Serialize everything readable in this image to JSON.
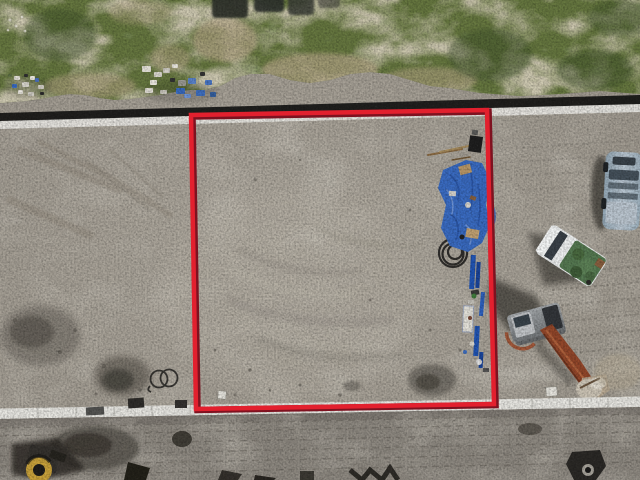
{
  "scene": {
    "type": "aerial-drone-photograph",
    "description": "Top-down drone photo of a graded vacant dirt lot outlined by a red rectangular property-boundary overlay; grass verge, debris piles and asphalt road edge across the top, white concrete curbs, a blue tarp with boxes and blue pipes along the right boundary, hose coils, dark excavation patches, a silver SUV, a white pickup with a green tarped load, a mini excavator, and a small compactor machine at the bottom left."
  },
  "boundary": {
    "shape": "rectangle",
    "stroke_color": "#e2202e",
    "edge_color": "#7e1220"
  },
  "colors": {
    "grass": "#677840",
    "grass_dark": "#3f5229",
    "grass_tan": "#b2a484",
    "dirt": "#a9a399",
    "dirt_light": "#bcb6aa",
    "dirt_dark_patch": "#5f5a52",
    "dirt_below_curb": "#8f8a82",
    "road_asphalt": "#161614",
    "curb": "#e9e8e3",
    "tarp_blue": "#3a6cc3",
    "tarp_blue_dark": "#274f9e",
    "pipe_blue": "#2155b5",
    "truck_body": "#f0f2f2",
    "truck_cargo_green": "#567a52",
    "truck_window": "#3a4148",
    "suv_body": "#aabbc8",
    "suv_window": "#45515b",
    "excavator_body": "#8f9396",
    "excavator_boom": "#93472a",
    "machine_drum_yellow": "#c9a23b",
    "hose": "#232220",
    "marker": "#e8e6df",
    "shadow": "#3c3a35",
    "cardboard": "#b99868",
    "pit_dark": "#2f322c"
  },
  "objects": [
    {
      "id": "red-boundary-overlay",
      "label": "red property boundary rectangle"
    },
    {
      "id": "grass-verge",
      "label": "grass verge with bare patches"
    },
    {
      "id": "trench-pits",
      "label": "dark excavated pits at top edge"
    },
    {
      "id": "debris-pile-left",
      "label": "small debris pile on grass (left)"
    },
    {
      "id": "debris-pile-right",
      "label": "large debris pile with blue tarps"
    },
    {
      "id": "asphalt-road-edge",
      "label": "dark asphalt road edge"
    },
    {
      "id": "top-curb",
      "label": "white curb strip below road"
    },
    {
      "id": "graded-lot",
      "label": "graded sandy dirt lot"
    },
    {
      "id": "blue-tarp",
      "label": "blue tarp with boxes"
    },
    {
      "id": "blue-pipes",
      "label": "blue pipes / lumber along boundary"
    },
    {
      "id": "hose-coil-small",
      "label": "small wire coil"
    },
    {
      "id": "hose-coil-large",
      "label": "coiled black hose"
    },
    {
      "id": "survey-markers",
      "label": "white survey markers"
    },
    {
      "id": "dark-patches",
      "label": "dark wet excavation patches"
    },
    {
      "id": "silver-suv",
      "label": "silver SUV parked at right"
    },
    {
      "id": "pickup-truck",
      "label": "white pickup with green covered load"
    },
    {
      "id": "mini-excavator",
      "label": "mini excavator with orange boom"
    },
    {
      "id": "compactor",
      "label": "compactor machine bottom-left"
    },
    {
      "id": "bottom-curb",
      "label": "white curb strip across bottom"
    },
    {
      "id": "tire-tracks",
      "label": "tire and track marks in dirt"
    }
  ]
}
